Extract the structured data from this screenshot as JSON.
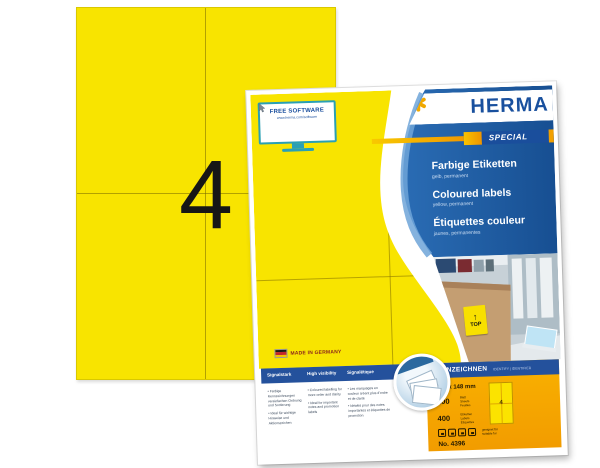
{
  "colors": {
    "label_yellow": "#F8E400",
    "herma_blue": "#19509E",
    "panel_blue": "#1E63AE",
    "bar_blue": "#24519C",
    "accent_orange": "#F2A000",
    "star_gold": "#F0A800"
  },
  "sheet": {
    "big_number": "4"
  },
  "package": {
    "software_promo": {
      "title": "FREE SOFTWARE",
      "url": "www.herma.com/software"
    },
    "brand": {
      "name": "HERMA",
      "badge": "SPECIAL"
    },
    "product_titles": [
      {
        "title": "Farbige Etiketten",
        "subtitle": "gelb, permanent"
      },
      {
        "title": "Coloured labels",
        "subtitle": "yellow, permanent"
      },
      {
        "title": "Étiquettes couleur",
        "subtitle": "jaunes, permanentes"
      }
    ],
    "made_in": "MADE IN GERMANY",
    "photo": {
      "box_sticker_arrow": "↑",
      "box_sticker_text": "TOP"
    },
    "benefits_columns": [
      {
        "header": "Signalstark",
        "bullets": [
          "Farbige Kennzeichnungen vereinfachen Ordnung und Sortierung",
          "Ideal für wichtige Hinweise und Aktionszeichen"
        ]
      },
      {
        "header": "High visibility",
        "bullets": [
          "Coloured labelling for more order and clarity",
          "Ideal for important notes and promotion labels"
        ]
      },
      {
        "header": "Signalétique",
        "bullets": [
          "Les marquages en couleur créent plus d'ordre et de clarté",
          "Idéales pour des notes importantes et étiquettes de promotion"
        ]
      }
    ],
    "spec_panel": {
      "header": "KENNZEICHNEN",
      "header_sub": "IDENTIFY | IDENTIFIER",
      "label_size": "105 x 148 mm",
      "sheets": {
        "count": "100",
        "units": [
          "Blatt",
          "Sheets",
          "Feuilles"
        ]
      },
      "labels": {
        "count": "400",
        "units": [
          "Etiketten",
          "Labels",
          "Étiquettes"
        ]
      },
      "printer_note": [
        "geeignet für",
        "suitable for"
      ],
      "article_no": "No. 4396",
      "mini_sheet_number": "4"
    }
  }
}
